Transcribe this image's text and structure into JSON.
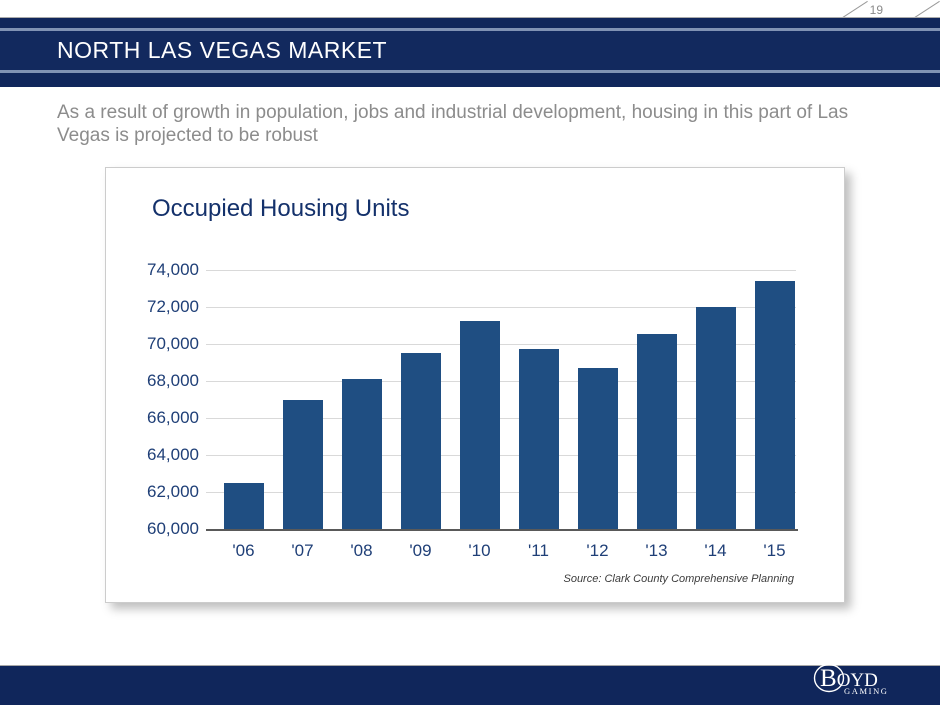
{
  "page": {
    "number": "19"
  },
  "header": {
    "title": "NORTH LAS VEGAS MARKET"
  },
  "subtitle": "As a result of growth in population, jobs and industrial development, housing in this part of Las Vegas is projected to be robust",
  "chart_data": {
    "type": "bar",
    "title": "Occupied Housing Units",
    "categories": [
      "'06",
      "'07",
      "'08",
      "'09",
      "'10",
      "'11",
      "'12",
      "'13",
      "'14",
      "'15"
    ],
    "values": [
      62500,
      67000,
      68100,
      69500,
      71250,
      69750,
      68700,
      70550,
      72000,
      73400
    ],
    "ylim": [
      60000,
      74000
    ],
    "ytick_step": 2000,
    "ytick_labels": [
      "60,000",
      "62,000",
      "64,000",
      "66,000",
      "68,000",
      "70,000",
      "72,000",
      "74,000"
    ],
    "grid": true,
    "legend": "none",
    "bar_color": "#1f4e82",
    "source": "Source: Clark County Comprehensive Planning"
  },
  "footer": {
    "logo_line1": "B",
    "logo_line1b": "OYD",
    "logo_line2": "GAMING"
  },
  "colors": {
    "band_navy": "#10265b",
    "band_main": "#12295e",
    "band_accent_line": "#8092b4",
    "bar": "#1f4e82",
    "axis_text": "#1f3f77",
    "chart_title": "#14316b",
    "subtitle_text": "#8c8c8c",
    "gridline": "#d9d9d9"
  }
}
